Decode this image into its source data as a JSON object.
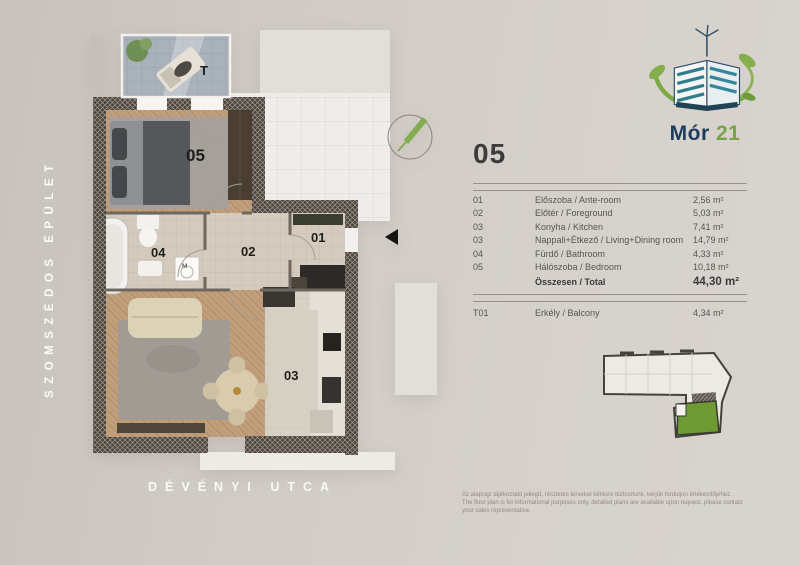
{
  "labels": {
    "neighbor_building": "SZOMSZÉDOS ÉPÜLET",
    "street": "DÉVÉNYI UTCA"
  },
  "logo": {
    "title": "Mór",
    "number": "21"
  },
  "panel": {
    "unit_number": "05",
    "rooms": [
      {
        "no": "01",
        "name": "Előszoba / Ante-room",
        "area": "2,56 m²"
      },
      {
        "no": "02",
        "name": "Előtér / Foreground",
        "area": "5,03 m²"
      },
      {
        "no": "03",
        "name": "Konyha / Kitchen",
        "area": "7,41 m²"
      },
      {
        "no": "03",
        "name": "Nappali+Étkező / Living+Dining room",
        "area": "14,79 m²"
      },
      {
        "no": "04",
        "name": "Fürdő / Bathroom",
        "area": "4,33 m²"
      },
      {
        "no": "05",
        "name": "Hálószoba / Bedroom",
        "area": "10,18 m²"
      }
    ],
    "total": {
      "label": "Összesen / Total",
      "area": "44,30 m²"
    },
    "balcony": {
      "no": "T01",
      "name": "Erkély / Balcony",
      "area": "4,34 m²"
    },
    "disclaimer_hu": "Az alaprajz tájékoztató jellegű, részletes terveket kérésre biztosítunk, kérjük forduljon értékesítőjéhez.",
    "disclaimer_en": "The floor plan is for informational purposes only, detailed plans are available upon request, please contact your sales representative."
  },
  "plan": {
    "room_labels": {
      "balcony": "T",
      "bedroom": "05",
      "bathroom": "04",
      "hall": "02",
      "entry": "01",
      "living": "03",
      "washer": "M"
    }
  },
  "colors": {
    "background": "#d2ccc6",
    "logo_navy": "#1d3d5e",
    "logo_green": "#7aa345",
    "wall": "#4a443d",
    "unit_highlight_green": "#6d9a33",
    "wood_floor": "#c29f7c",
    "balcony_tile": "#a9b2ba"
  }
}
